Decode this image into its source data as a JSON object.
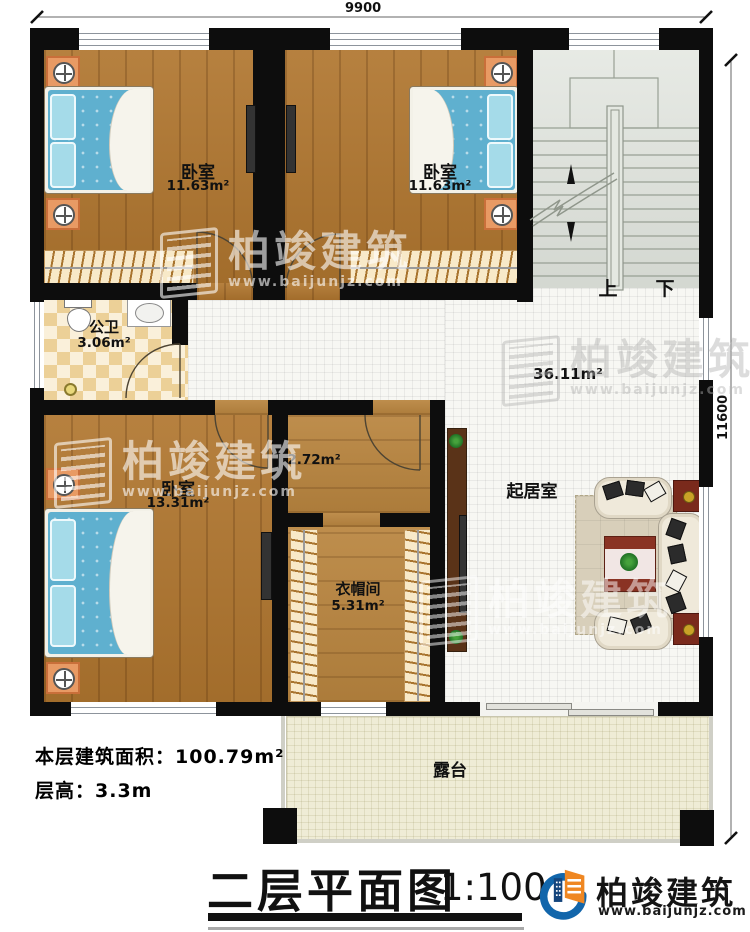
{
  "plan": {
    "dim_top": "9900",
    "dim_right": "11600",
    "rooms": {
      "bedroom_top_left": {
        "name": "卧室",
        "area": "11.63m²"
      },
      "bedroom_top_mid": {
        "name": "卧室",
        "area": "11.63m²"
      },
      "bedroom_left": {
        "name": "卧室",
        "area": "13.31m²"
      },
      "bathroom": {
        "name": "公卫",
        "area": "3.06m²"
      },
      "hall": {
        "area": "2.72m²"
      },
      "cloakroom": {
        "name": "衣帽间",
        "area": "5.31m²"
      },
      "living_room": {
        "name": "起居室",
        "area": "36.11m²"
      },
      "terrace": {
        "name": "露台"
      },
      "stairs": {
        "up_label": "上",
        "down_label": "下"
      }
    }
  },
  "notes": {
    "floor_area_label": "本层建筑面积：100.79m²",
    "floor_height_label": "层高：3.3m"
  },
  "title_block": {
    "title": "二层平面图",
    "scale": "1:100"
  },
  "brand": {
    "name": "柏竣建筑",
    "url": "www.baijunjz.com"
  },
  "watermark": {
    "name": "柏竣建筑",
    "url": "www.baijunjz.com"
  },
  "colors": {
    "wall": "#0d0d0d",
    "wood": "#b0762f",
    "tile": "#f7f7f3",
    "terrace": "#efecd6",
    "brand_blue": "#1266ab",
    "brand_orange": "#ef8722"
  }
}
